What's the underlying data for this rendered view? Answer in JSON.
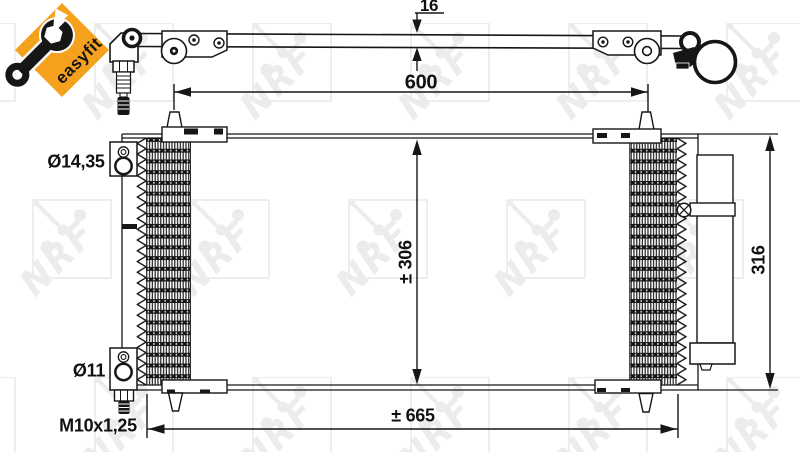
{
  "drawing": {
    "brand_watermark": "NRF",
    "badge_label": "easyfit",
    "dim_pipe_thickness": "16",
    "dim_pipe_length": "600",
    "dim_core_height": "± 306",
    "dim_total_height": "316",
    "dim_total_width": "± 665",
    "label_port_top_diameter": "Ø14,35",
    "label_port_bottom_diameter": "Ø11",
    "label_thread": "M10x1,25"
  },
  "colors": {
    "accent_orange": "#F5A11E",
    "line_black": "#161616",
    "watermark_gray": "#ECECEC"
  }
}
